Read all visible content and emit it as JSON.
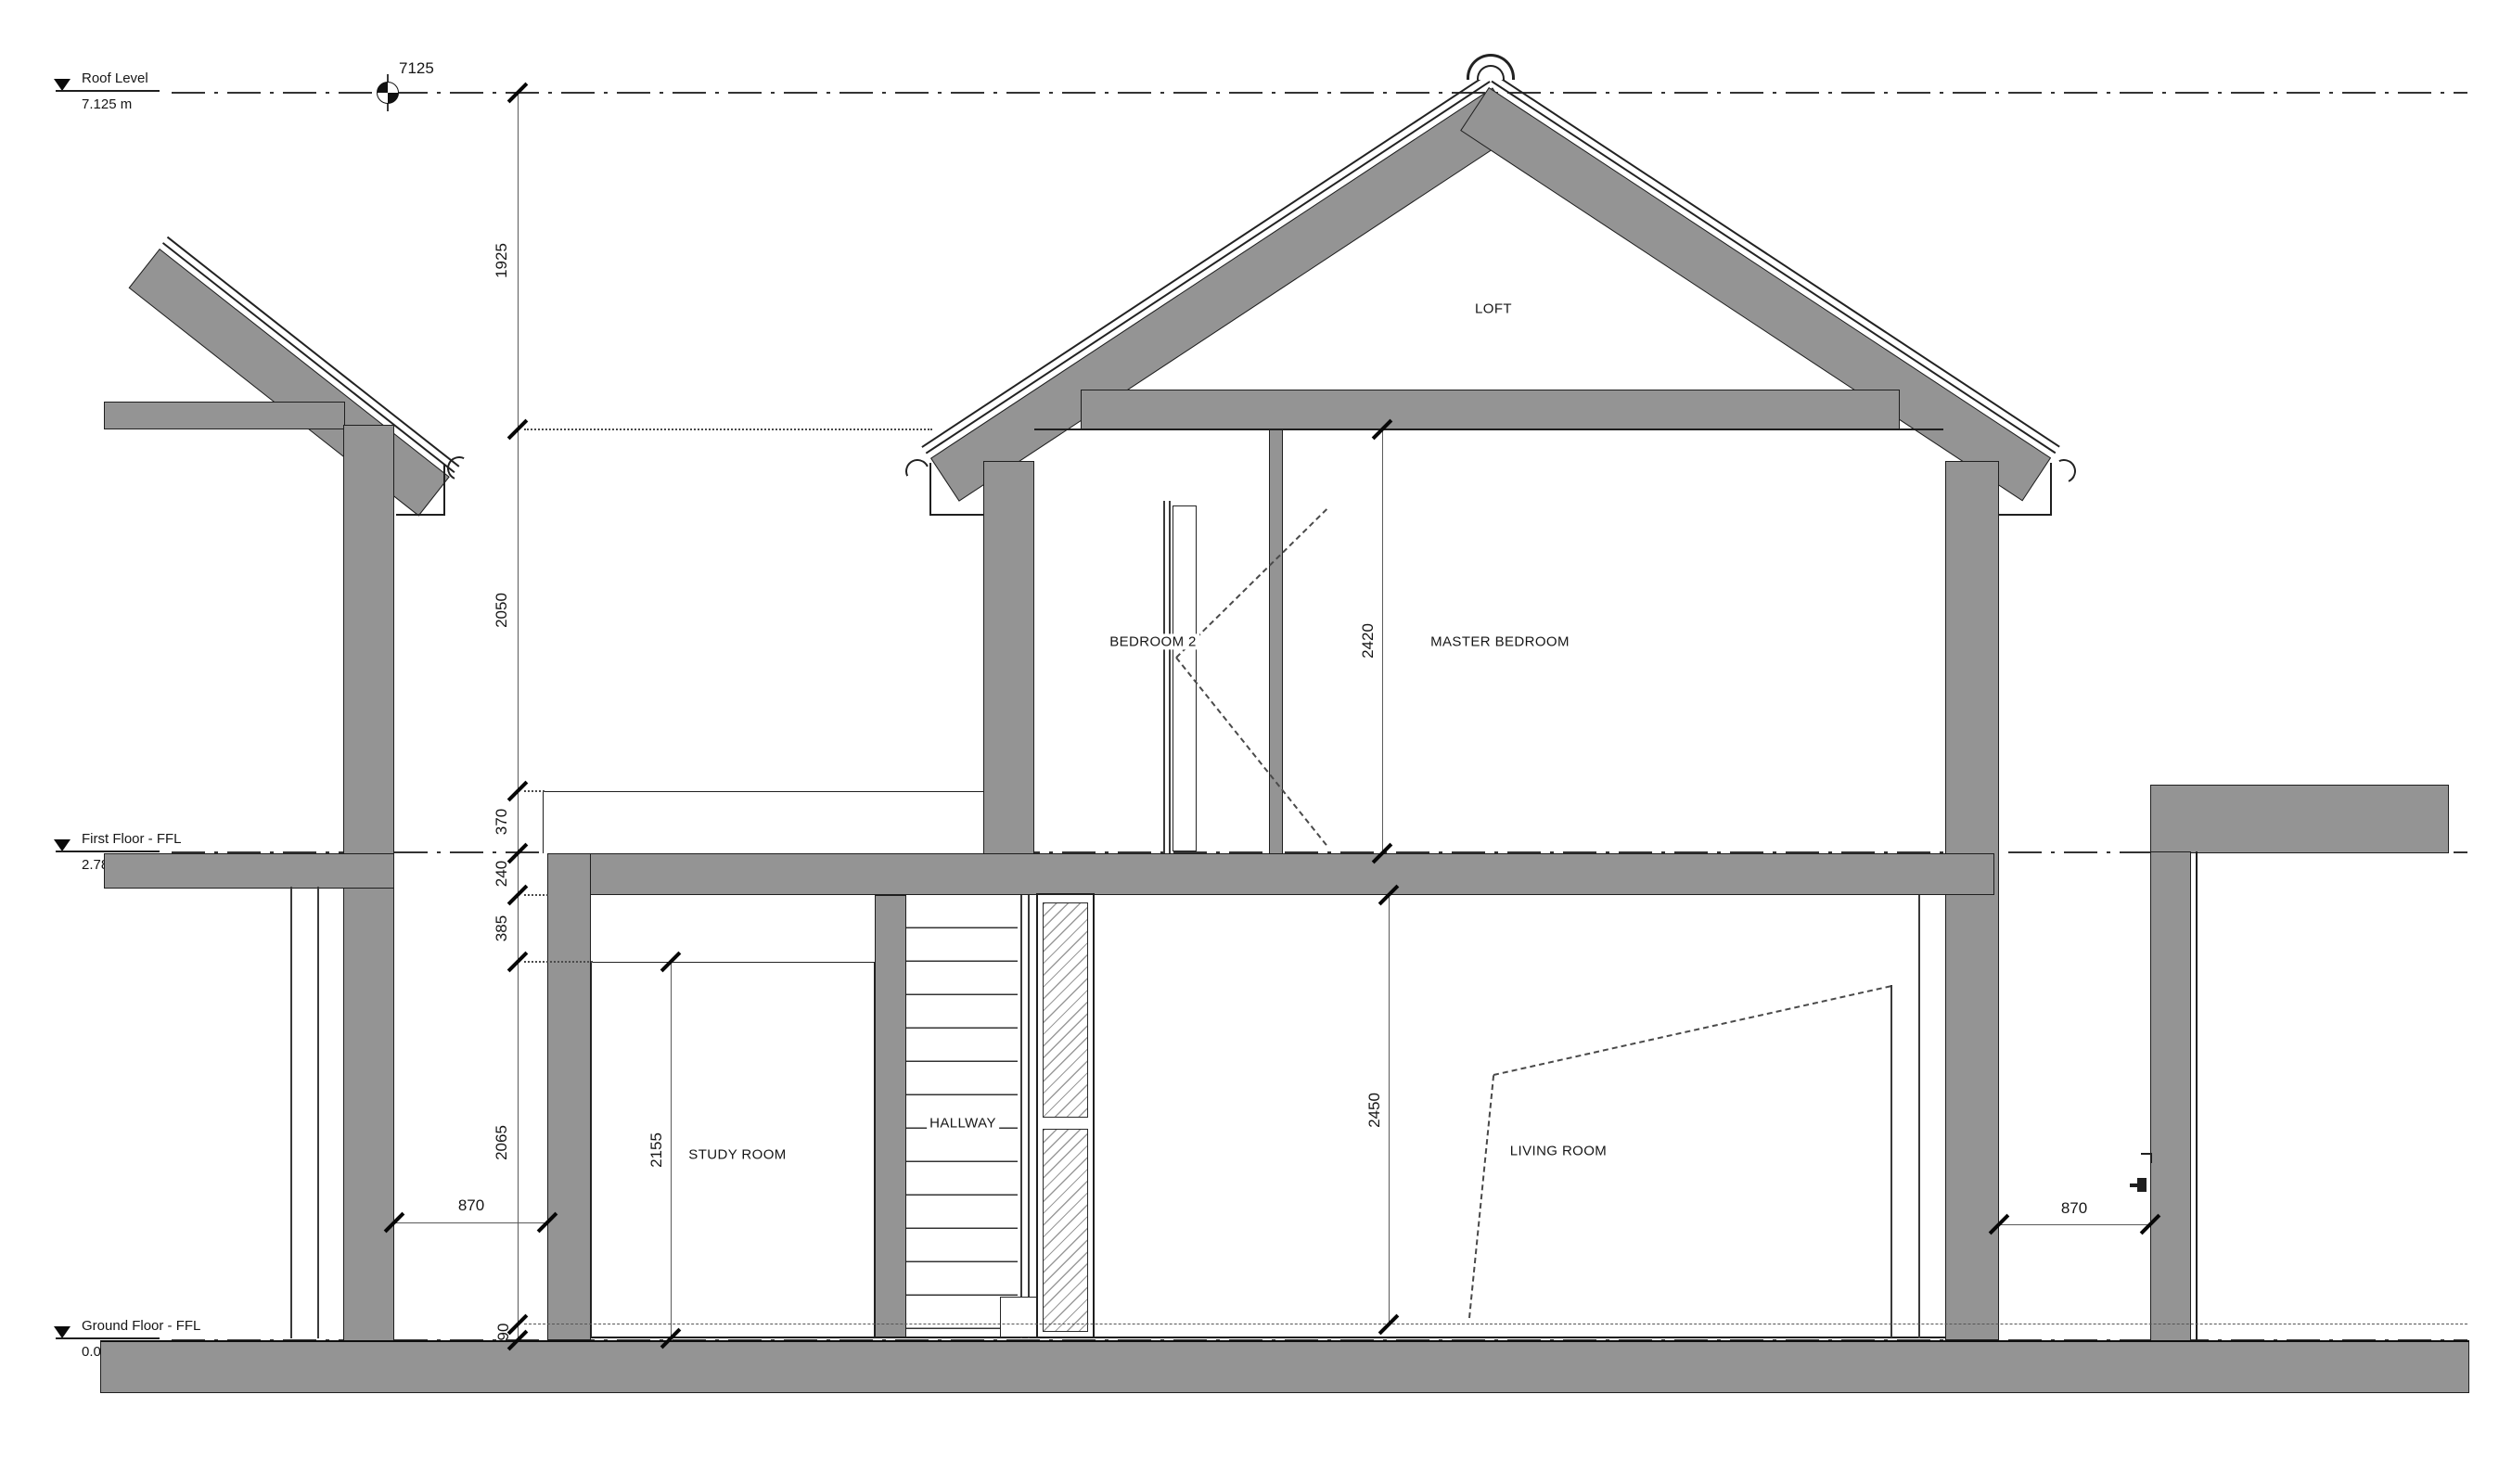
{
  "drawing": {
    "levels": [
      {
        "name": "Roof Level",
        "elevation": "7.125 m"
      },
      {
        "name": "First Floor - FFL",
        "elevation": "2.780 m"
      },
      {
        "name": "Ground Floor - FFL",
        "elevation": "0.000 m"
      }
    ],
    "spot_elevation": "7125",
    "rooms": {
      "loft": "LOFT",
      "bedroom2": "BEDROOM 2",
      "master": "MASTER BEDROOM",
      "study": "STUDY ROOM",
      "hallway": "HALLWAY",
      "living": "LIVING ROOM"
    },
    "dims": {
      "chain": [
        "1925",
        "2050",
        "370",
        "240",
        "385",
        "2065",
        "90"
      ],
      "master_height": "2420",
      "study_height": "2155",
      "living_height": "2450",
      "left_gap": "870",
      "right_gap": "870"
    },
    "colors": {
      "wall": "#949494",
      "line": "#1f1f1f"
    }
  }
}
